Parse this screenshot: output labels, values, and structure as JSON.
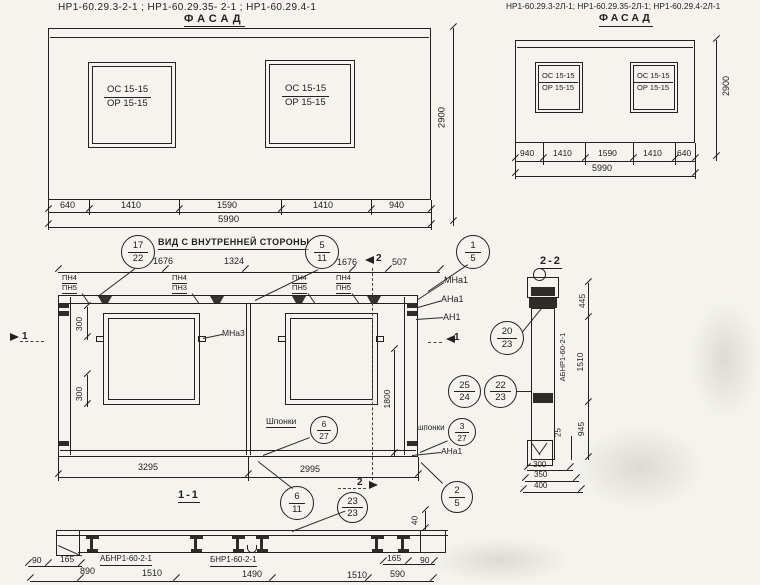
{
  "facade_left": {
    "title": "НР1-60.29.3-2-1 ;   НР1-60.29.35- 2-1 ;   НР1-60.29.4-1",
    "view_label": "ФАСАД",
    "win_top": "ОС 15-15",
    "win_bottom": "ОР 15-15",
    "dims": [
      "640",
      "1410",
      "1590",
      "1410",
      "940"
    ],
    "total": "5990",
    "height": "2900"
  },
  "facade_right": {
    "title": "НР1-60.29.3-2Л-1; НР1-60.29.35-2Л-1; НР1-60.29.4-2Л-1",
    "view_label": "ФАСАД",
    "win_top": "ОС 15-15",
    "win_bottom": "ОР 15-15",
    "dims": [
      "940",
      "1410",
      "1590",
      "1410",
      "640"
    ],
    "total": "5990",
    "height": "2900"
  },
  "inner": {
    "title": "ВИД С ВНУТРЕННЕЙ СТОРОНЫ",
    "top_dims": [
      "1676",
      "1324",
      "1676",
      "507"
    ],
    "pn": [
      {
        "t": "ПН4",
        "b": "ПН5"
      },
      {
        "t": "ПН4",
        "b": "ПН3"
      },
      {
        "t": "ПН4",
        "b": "ПН5"
      },
      {
        "t": "ПН4",
        "b": "ПН5"
      }
    ],
    "dim300_top": "300",
    "dim300_bot": "300",
    "dim1800": "1800",
    "mna3": "МНа3",
    "mna1": "МНа1",
    "ana1": "АНа1",
    "an1": "АН1",
    "ana1_bot": "АНа1",
    "shponki_left": "Шпонки",
    "shponki_right": "шпонки",
    "bottom_dims": [
      "3295",
      "2995"
    ],
    "section11_label": "1-1",
    "mark1": "1",
    "mark2": "2"
  },
  "callouts": {
    "c17_22": {
      "t": "17",
      "b": "22"
    },
    "c5_11": {
      "t": "5",
      "b": "11"
    },
    "c1_5": {
      "t": "1",
      "b": "5"
    },
    "c20_23": {
      "t": "20",
      "b": "23"
    },
    "c25_24": {
      "t": "25",
      "b": "24"
    },
    "c22_23": {
      "t": "22",
      "b": "23"
    },
    "c6_27": {
      "t": "6",
      "b": "27"
    },
    "c3_27": {
      "t": "3",
      "b": "27"
    },
    "c6_11": {
      "t": "6",
      "b": "11"
    },
    "c23_23": {
      "t": "23",
      "b": "23"
    },
    "c2_5": {
      "t": "2",
      "b": "5"
    }
  },
  "sec22": {
    "title": "2-2",
    "part": "АБНР1-60-2-1",
    "d445": "445",
    "d1510": "1510",
    "d945": "945",
    "d25": "25",
    "d300": "300",
    "d350": "350",
    "d400": "400"
  },
  "sec11": {
    "part_left": "АБНР1-60-2-1",
    "part_right": "БНР1-60-2-1",
    "d40": "40",
    "d90l": "90",
    "d165l": "165",
    "d165r": "165",
    "d90r": "90",
    "row2": [
      "890",
      "1510",
      "1490",
      "1510",
      "590"
    ]
  }
}
